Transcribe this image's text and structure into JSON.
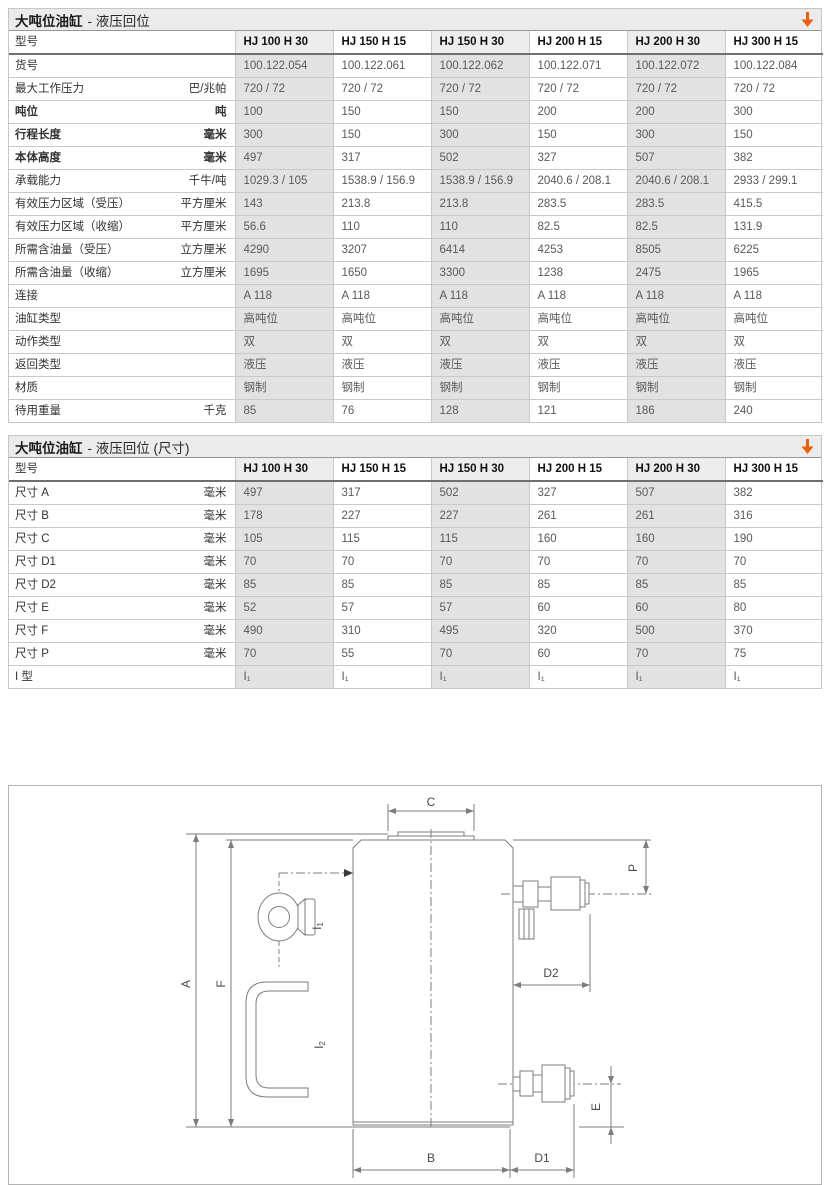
{
  "colors": {
    "accent": "#e8600c",
    "column_shade": "#e2e2e2",
    "drawing_line": "#7d7d7d"
  },
  "tables": [
    {
      "title_main": "大吨位油缸",
      "title_rest": "- 液压回位",
      "col_header_label": "型号",
      "columns": [
        "HJ 100 H 30",
        "HJ 150 H 15",
        "HJ 150 H 30",
        "HJ 200 H 15",
        "HJ 200 H 30",
        "HJ 300 H 15"
      ],
      "rows": [
        {
          "label": "货号",
          "unit": "",
          "bold": false,
          "values": [
            "100.122.054",
            "100.122.061",
            "100.122.062",
            "100.122.071",
            "100.122.072",
            "100.122.084"
          ]
        },
        {
          "label": "最大工作压力",
          "unit": "巴/兆帕",
          "bold": false,
          "values": [
            "720 / 72",
            "720 / 72",
            "720 / 72",
            "720 / 72",
            "720 / 72",
            "720 / 72"
          ]
        },
        {
          "label": "吨位",
          "unit": "吨",
          "bold": true,
          "values": [
            "100",
            "150",
            "150",
            "200",
            "200",
            "300"
          ]
        },
        {
          "label": "行程长度",
          "unit": "毫米",
          "bold": true,
          "values": [
            "300",
            "150",
            "300",
            "150",
            "300",
            "150"
          ]
        },
        {
          "label": "本体高度",
          "unit": "毫米",
          "bold": true,
          "values": [
            "497",
            "317",
            "502",
            "327",
            "507",
            "382"
          ]
        },
        {
          "label": "承载能力",
          "unit": "千牛/吨",
          "bold": false,
          "values": [
            "1029.3 / 105",
            "1538.9 / 156.9",
            "1538.9 / 156.9",
            "2040.6 / 208.1",
            "2040.6 / 208.1",
            "2933 / 299.1"
          ]
        },
        {
          "label": "有效压力区域（受压）",
          "unit": "平方厘米",
          "bold": false,
          "values": [
            "143",
            "213.8",
            "213.8",
            "283.5",
            "283.5",
            "415.5"
          ]
        },
        {
          "label": "有效压力区域（收缩）",
          "unit": "平方厘米",
          "bold": false,
          "values": [
            "56.6",
            "110",
            "110",
            "82.5",
            "82.5",
            "131.9"
          ]
        },
        {
          "label": "所需含油量（受压）",
          "unit": "立方厘米",
          "bold": false,
          "values": [
            "4290",
            "3207",
            "6414",
            "4253",
            "8505",
            "6225"
          ]
        },
        {
          "label": "所需含油量（收缩）",
          "unit": "立方厘米",
          "bold": false,
          "values": [
            "1695",
            "1650",
            "3300",
            "1238",
            "2475",
            "1965"
          ]
        },
        {
          "label": "连接",
          "unit": "",
          "bold": false,
          "values": [
            "A 118",
            "A 118",
            "A 118",
            "A 118",
            "A 118",
            "A 118"
          ]
        },
        {
          "label": "油缸类型",
          "unit": "",
          "bold": false,
          "values": [
            "高吨位",
            "高吨位",
            "高吨位",
            "高吨位",
            "高吨位",
            "高吨位"
          ]
        },
        {
          "label": "动作类型",
          "unit": "",
          "bold": false,
          "values": [
            "双",
            "双",
            "双",
            "双",
            "双",
            "双"
          ]
        },
        {
          "label": "返回类型",
          "unit": "",
          "bold": false,
          "values": [
            "液压",
            "液压",
            "液压",
            "液压",
            "液压",
            "液压"
          ]
        },
        {
          "label": "材质",
          "unit": "",
          "bold": false,
          "values": [
            "钢制",
            "钢制",
            "钢制",
            "钢制",
            "钢制",
            "钢制"
          ]
        },
        {
          "label": "待用重量",
          "unit": "千克",
          "bold": false,
          "values": [
            "85",
            "76",
            "128",
            "121",
            "186",
            "240"
          ]
        }
      ]
    },
    {
      "title_main": "大吨位油缸",
      "title_rest": "- 液压回位 (尺寸)",
      "col_header_label": "型号",
      "columns": [
        "HJ 100 H 30",
        "HJ 150 H 15",
        "HJ 150 H 30",
        "HJ 200 H 15",
        "HJ 200 H 30",
        "HJ 300 H 15"
      ],
      "rows": [
        {
          "label": "尺寸 A",
          "unit": "毫米",
          "bold": false,
          "values": [
            "497",
            "317",
            "502",
            "327",
            "507",
            "382"
          ]
        },
        {
          "label": "尺寸 B",
          "unit": "毫米",
          "bold": false,
          "values": [
            "178",
            "227",
            "227",
            "261",
            "261",
            "316"
          ]
        },
        {
          "label": "尺寸 C",
          "unit": "毫米",
          "bold": false,
          "values": [
            "105",
            "115",
            "115",
            "160",
            "160",
            "190"
          ]
        },
        {
          "label": "尺寸 D1",
          "unit": "毫米",
          "bold": false,
          "values": [
            "70",
            "70",
            "70",
            "70",
            "70",
            "70"
          ]
        },
        {
          "label": "尺寸 D2",
          "unit": "毫米",
          "bold": false,
          "values": [
            "85",
            "85",
            "85",
            "85",
            "85",
            "85"
          ]
        },
        {
          "label": "尺寸 E",
          "unit": "毫米",
          "bold": false,
          "values": [
            "52",
            "57",
            "57",
            "60",
            "60",
            "80"
          ]
        },
        {
          "label": "尺寸 F",
          "unit": "毫米",
          "bold": false,
          "values": [
            "490",
            "310",
            "495",
            "320",
            "500",
            "370"
          ]
        },
        {
          "label": "尺寸 P",
          "unit": "毫米",
          "bold": false,
          "values": [
            "70",
            "55",
            "70",
            "60",
            "70",
            "75"
          ]
        },
        {
          "label": "I 型",
          "unit": "",
          "bold": false,
          "values": [
            "I₁",
            "I₁",
            "I₁",
            "I₁",
            "I₁",
            "I₁"
          ]
        }
      ]
    }
  ],
  "diagram": {
    "dims": {
      "a": "A",
      "b": "B",
      "c": "C",
      "d1": "D1",
      "d2": "D2",
      "e": "E",
      "f": "F",
      "p": "P"
    },
    "callouts": {
      "i1_base": "I",
      "i1_sub": "1",
      "i2_base": "I",
      "i2_sub": "2"
    }
  }
}
